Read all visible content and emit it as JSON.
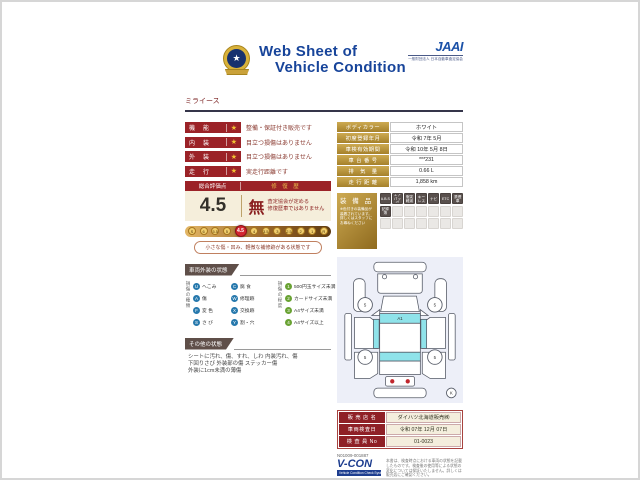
{
  "header": {
    "title_line1": "Web Sheet of",
    "title_line2": "Vehicle Condition",
    "jaai_logo": "JAAI",
    "jaai_sub": "一般財団法人 日本自動車査定協会",
    "model_name": "ミライース"
  },
  "ratings": {
    "star": "★",
    "rows": [
      {
        "label": "機　能",
        "desc": "整備・保証付き販売です"
      },
      {
        "label": "内　装",
        "desc": "目立つ損傷はありません"
      },
      {
        "label": "外　装",
        "desc": "目立つ損傷はありません"
      },
      {
        "label": "走　行",
        "desc": "実走行距離です"
      }
    ],
    "overall_label": "総合評価点",
    "repair_label": "修 復 歴",
    "overall_score": "4.5",
    "repair_value": "無",
    "repair_note1": "査定協会が定める",
    "repair_note2": "修復歴車ではありません",
    "scale": [
      "S",
      "6",
      "5.5",
      "5",
      "4.5",
      "4",
      "3.5",
      "3",
      "2.5",
      "2",
      "1",
      "R"
    ],
    "scale_active": "4.5",
    "scale_note": "小さな傷・凹み、軽微な補修跡がある状態です"
  },
  "specs": {
    "rows": [
      {
        "label": "ボディカラー",
        "value": "ホワイト"
      },
      {
        "label": "初度登録年月",
        "value": "令和 7年 5月"
      },
      {
        "label": "車検有効期間",
        "value": "令和 10年 5月 8日"
      },
      {
        "label": "車 台 番 号",
        "value": "***231"
      },
      {
        "label": "排　気　量",
        "value": "0.66 L"
      },
      {
        "label": "走 行 距 離",
        "value": "1,858 km"
      }
    ]
  },
  "equipment": {
    "title": "装 備 品",
    "note": "※色付きの装備品が装着されています。詳しくはスタッフにお尋ねください",
    "badges": [
      {
        "label": "A.B.S",
        "active": true
      },
      {
        "label": "エアバッグ",
        "active": true
      },
      {
        "label": "衝突軽減",
        "active": true
      },
      {
        "label": "キーレス",
        "active": true
      },
      {
        "label": "ナビ",
        "active": true
      },
      {
        "label": "ETC",
        "active": true
      },
      {
        "label": "禁煙車",
        "active": true
      },
      {
        "label": "記録簿",
        "active": true
      },
      {
        "label": "",
        "active": false
      },
      {
        "label": "",
        "active": false
      },
      {
        "label": "",
        "active": false
      },
      {
        "label": "",
        "active": false
      },
      {
        "label": "",
        "active": false
      },
      {
        "label": "",
        "active": false
      },
      {
        "label": "",
        "active": false
      },
      {
        "label": "",
        "active": false
      },
      {
        "label": "",
        "active": false
      },
      {
        "label": "",
        "active": false
      },
      {
        "label": "",
        "active": false
      },
      {
        "label": "",
        "active": false
      },
      {
        "label": "",
        "active": false
      }
    ]
  },
  "exterior": {
    "section_title": "車両外装の状態",
    "type_label": "損傷の種類",
    "degree_label": "損傷の程度",
    "types": [
      {
        "sym": "U",
        "label": "へこみ"
      },
      {
        "sym": "C",
        "label": "腐 食"
      },
      {
        "sym": "A",
        "label": "傷"
      },
      {
        "sym": "W",
        "label": "修理跡"
      },
      {
        "sym": "F",
        "label": "変 色"
      },
      {
        "sym": "X",
        "label": "交換跡"
      },
      {
        "sym": "S",
        "label": "さ び"
      },
      {
        "sym": "Y",
        "label": "割・穴"
      }
    ],
    "degrees": [
      {
        "sym": "1",
        "label": "500円玉サイズ未満"
      },
      {
        "sym": "2",
        "label": "カードサイズ未満"
      },
      {
        "sym": "3",
        "label": "A4サイズ未満"
      },
      {
        "sym": "4",
        "label": "A4サイズ以上"
      }
    ]
  },
  "other": {
    "section_title": "その他の状態",
    "lines": [
      "シートに汚れ、傷、すれ、しわ 内装汚れ、傷",
      "下回りさび 外装部の傷 ステッカー傷",
      "外装に1cm未満の薄傷"
    ]
  },
  "diagram": {
    "windshield_mark": "A1",
    "tire_mark": "5",
    "corner_mark": "K",
    "glass_color": "#8fe3ea",
    "lamp_color": "#c1272d"
  },
  "dealer": {
    "rows": [
      {
        "label": "販 売 店 名",
        "value": "ダイハツ北海道販売㈱"
      },
      {
        "label": "車両検査日",
        "value": "令和 07年 12月 07日"
      },
      {
        "label": "検 査 員 No",
        "value": "01-0023"
      }
    ],
    "code": "N01009-001887",
    "vcon": "V-CON",
    "vcon_sub": "Vehicle Condition Check System",
    "disclaimer": "本書は、検査時点における車両の状態を記載したものです。検査後の使用等による状態の変化については保証いたしません。詳しくは販売店にご確認ください。"
  },
  "colors": {
    "maroon": "#9b2227",
    "gold": "#b9933c",
    "navy": "#17449a",
    "glass": "#8fe3ea",
    "active_red": "#d22630"
  }
}
